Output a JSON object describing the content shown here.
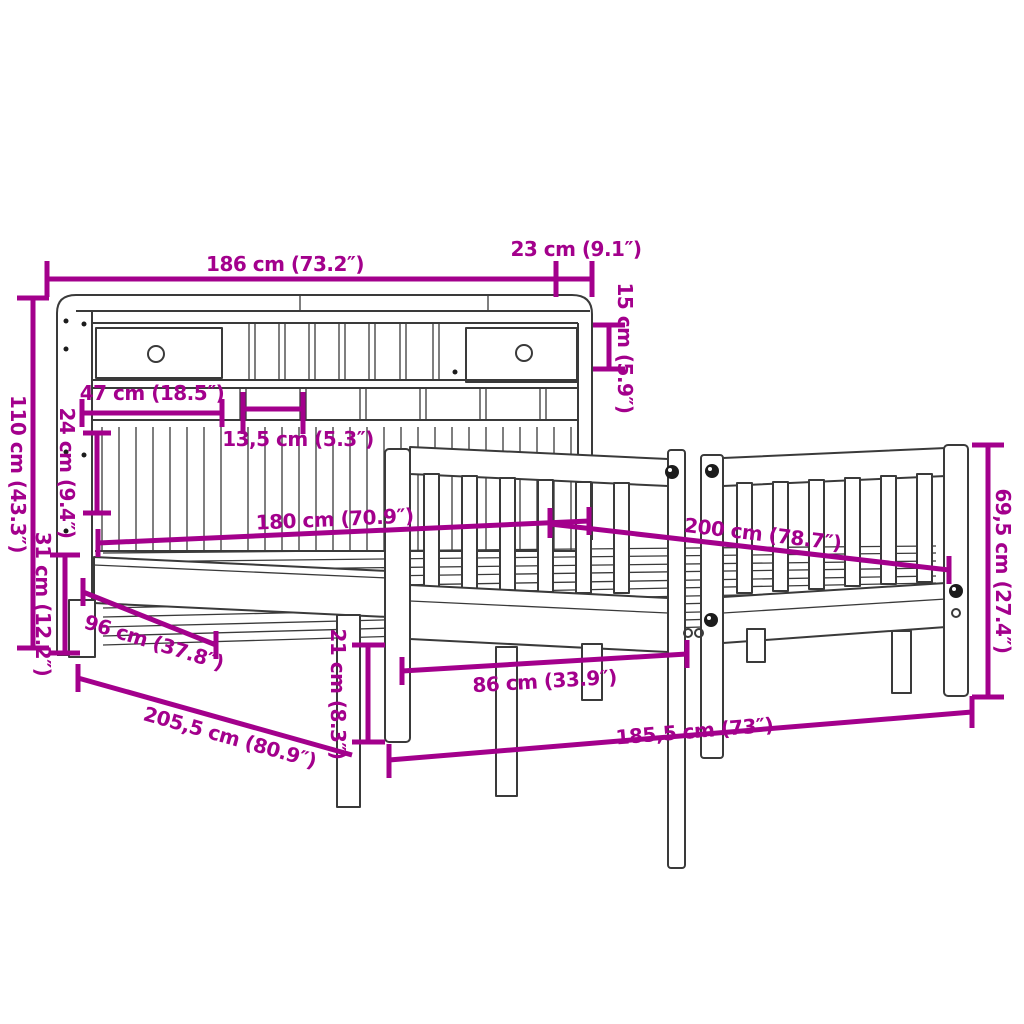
{
  "diagram": {
    "kind": "product-dimension-diagram",
    "subject": "bed frame with bookcase headboard",
    "background": "#ffffff",
    "line_color": "#3a3a3a",
    "dimension_color": "#A3008C",
    "dims": {
      "d186": "186 cm (73.2″)",
      "d23": "23 cm (9.1″)",
      "d15": "15 cm (5.9″)",
      "d110": "110 cm (43.3″)",
      "d47": "47 cm (18.5″)",
      "d13_5": "13,5 cm (5.3″)",
      "d24": "24 cm (9.4″)",
      "d31": "31 cm (12.2″)",
      "d180": "180 cm (70.9″)",
      "d200": "200 cm (78.7″)",
      "d96": "96 cm (37.8″)",
      "d21": "21 cm (8.3″)",
      "d86": "86 cm (33.9″)",
      "d205_5": "205,5 cm (80.9″)",
      "d185_5": "185,5 cm (73″)",
      "d69_5": "69,5 cm (27.4″)"
    }
  }
}
